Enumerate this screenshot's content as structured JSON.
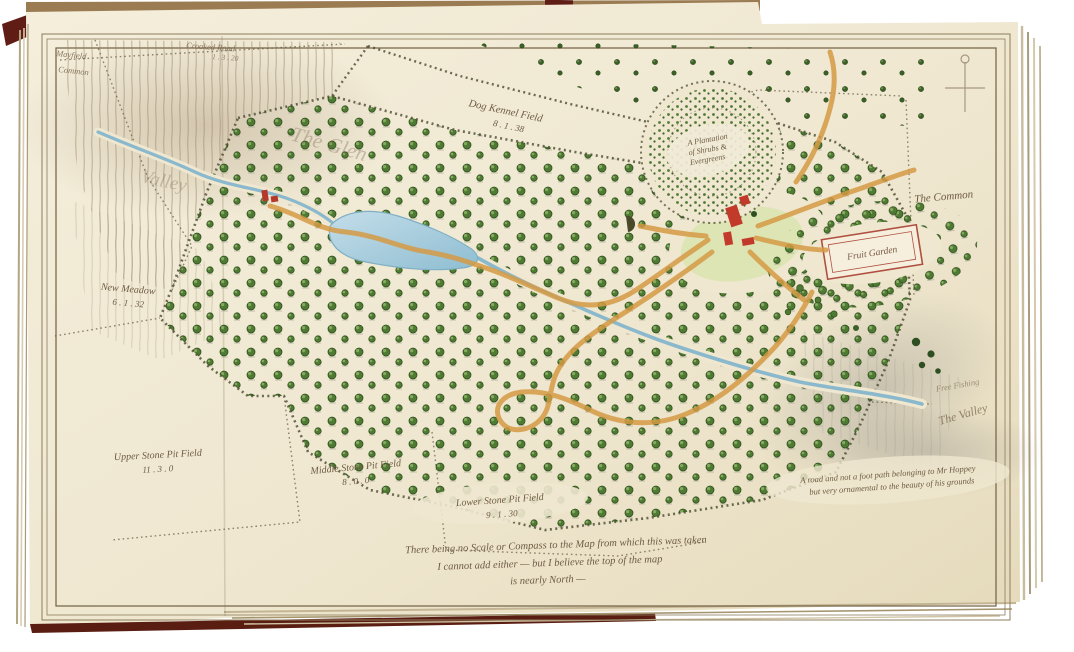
{
  "map": {
    "labels": {
      "corner_title": {
        "line1": "Mayfield",
        "line2": "Common"
      },
      "crooked_road": {
        "name": "Crooked Road",
        "acreage": "1 . 3 . 20"
      },
      "hillside": {
        "line1": "The Glen",
        "line2": "Valley"
      },
      "dog_kennel": {
        "name": "Dog Kennel Field",
        "acreage": "8 . 1 . 38"
      },
      "new_meadow": {
        "name": "New Meadow",
        "acreage": "6 . 1 . 32"
      },
      "upper_stone": {
        "name": "Upper Stone Pit Field",
        "acreage": "11 . 3 . 0"
      },
      "middle_stone": {
        "name": "Middle Stone Pit Field",
        "acreage": "8 . 0 . 0"
      },
      "lower_stone": {
        "name": "Lower Stone Pit Field",
        "acreage": "9 . 1 . 30"
      },
      "plantation": {
        "line1": "A Plantation",
        "line2": "of Shrubs &",
        "line3": "Evergreens"
      },
      "fruit_garden": "Fruit Garden",
      "the_common": "The Common",
      "free_fishing": "Free Fishing",
      "the_valley": "The Valley",
      "road_note": {
        "line1": "A road and not a foot path belonging to Mr Hoppey",
        "line2": "but very ornamental to the beauty of his grounds"
      },
      "inscription": {
        "line1": "There being no Scale or Compass to the Map from which this was taken",
        "line2": "I cannot add either — but I believe the top of the map",
        "line3": "is nearly North —"
      }
    },
    "colors": {
      "page": "#efe7d0",
      "ink": "#6e5c43",
      "tree": "#4e7a33",
      "water": "#a9cede",
      "path_orange": "#d59a44",
      "building_red": "#c23b2a",
      "cover_maroon": "#5f1d15",
      "frame_line": "#8d7c5c"
    }
  }
}
